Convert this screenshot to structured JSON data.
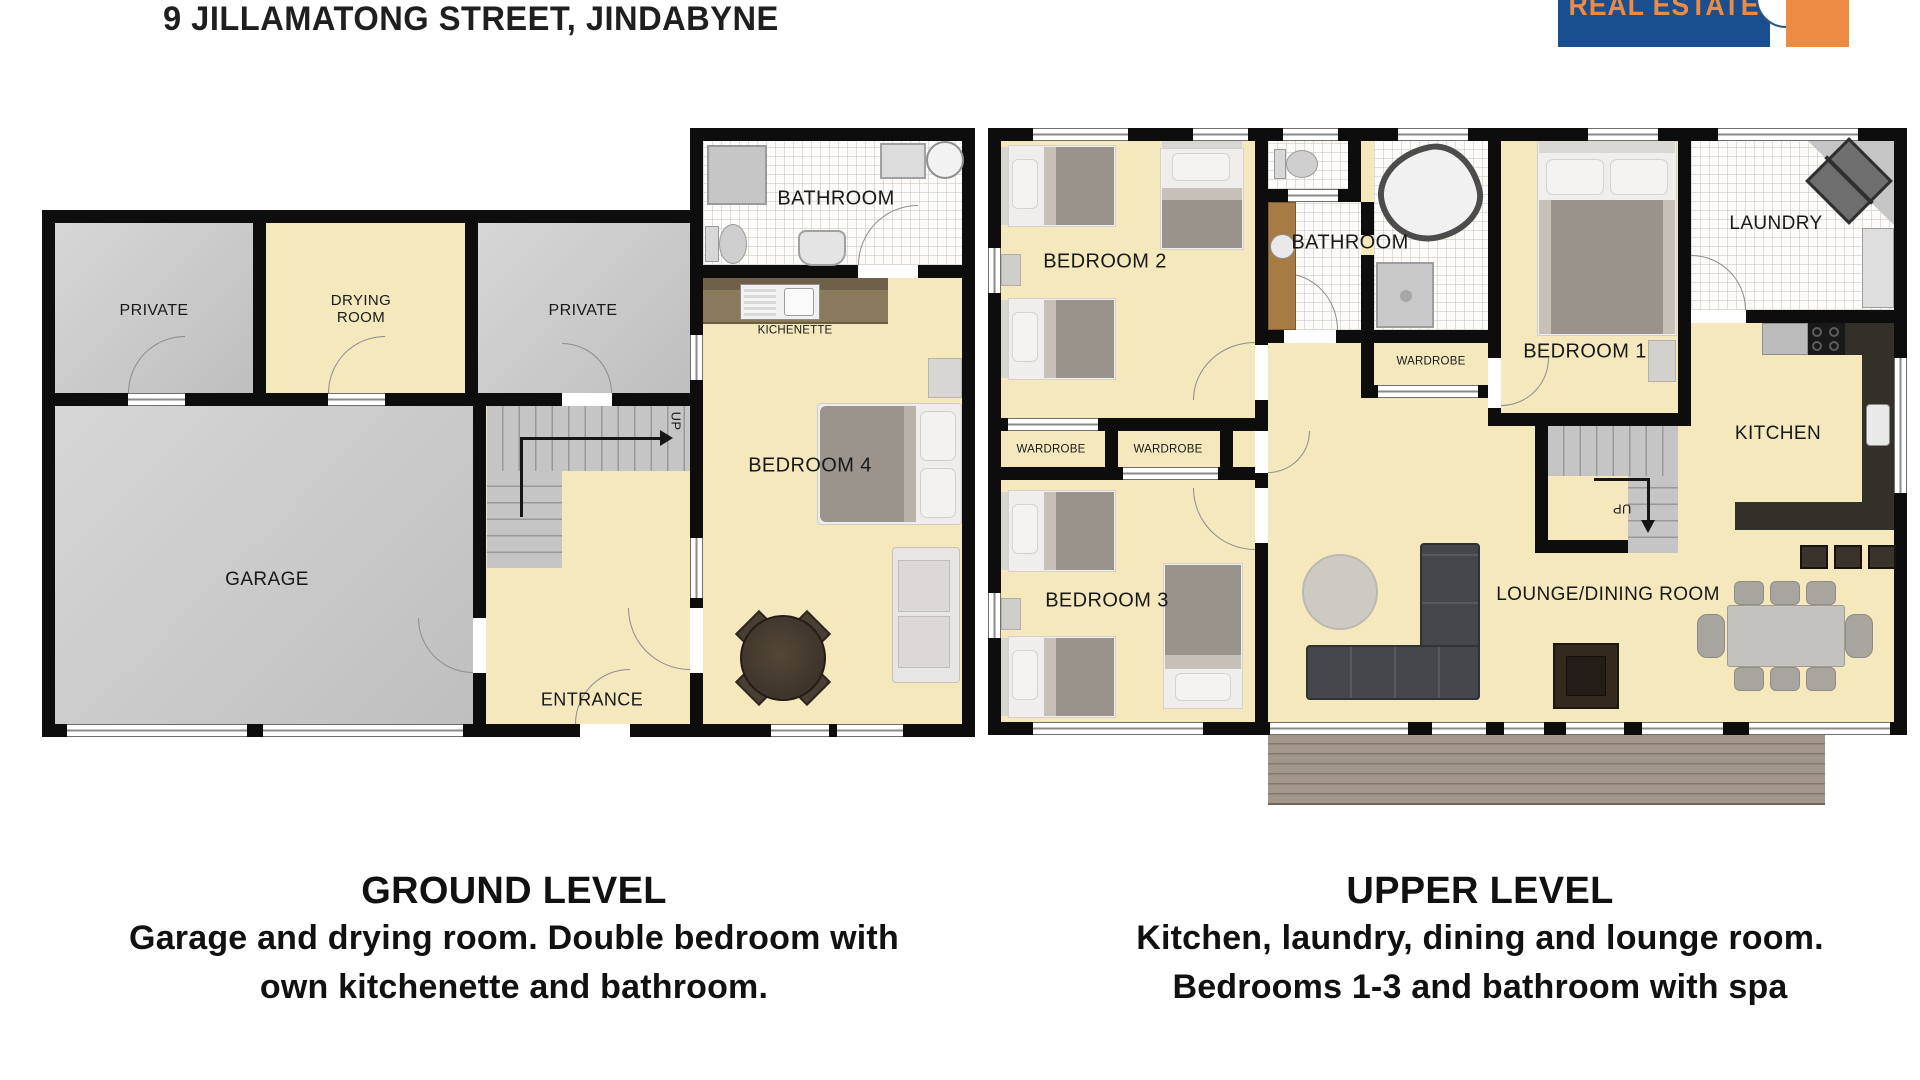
{
  "header": {
    "address": "9 JILLAMATONG STREET, JINDABYNE"
  },
  "logo": {
    "text": "REAL ESTATE",
    "blue": "#1a4e8e",
    "orange": "#ec8b41"
  },
  "ground": {
    "labels": {
      "private1": "PRIVATE",
      "drying": "DRYING\nROOM",
      "private2": "PRIVATE",
      "bathroom": "BATHROOM",
      "kichenette": "KICHENETTE",
      "bedroom4": "BEDROOM 4",
      "garage": "GARAGE",
      "entrance": "ENTRANCE",
      "up": "UP"
    },
    "caption": {
      "title": "GROUND LEVEL",
      "line1": "Garage and drying room. Double bedroom with",
      "line2": "own kitchenette and bathroom."
    }
  },
  "upper": {
    "labels": {
      "bedroom2": "BEDROOM 2",
      "bathroom": "BATHROOM",
      "laundry": "LAUNDRY",
      "bedroom1": "BEDROOM 1",
      "wardrobe_a": "WARDROBE",
      "wardrobe_b": "WARDROBE",
      "wardrobe_c": "WARDROBE",
      "bedroom3": "BEDROOM 3",
      "kitchen": "KITCHEN",
      "lounge": "LOUNGE/DINING ROOM",
      "up": "UP"
    },
    "caption": {
      "title": "UPPER LEVEL",
      "line1": "Kitchen, laundry, dining and lounge room.",
      "line2": "Bedrooms 1-3 and bathroom with spa"
    }
  }
}
